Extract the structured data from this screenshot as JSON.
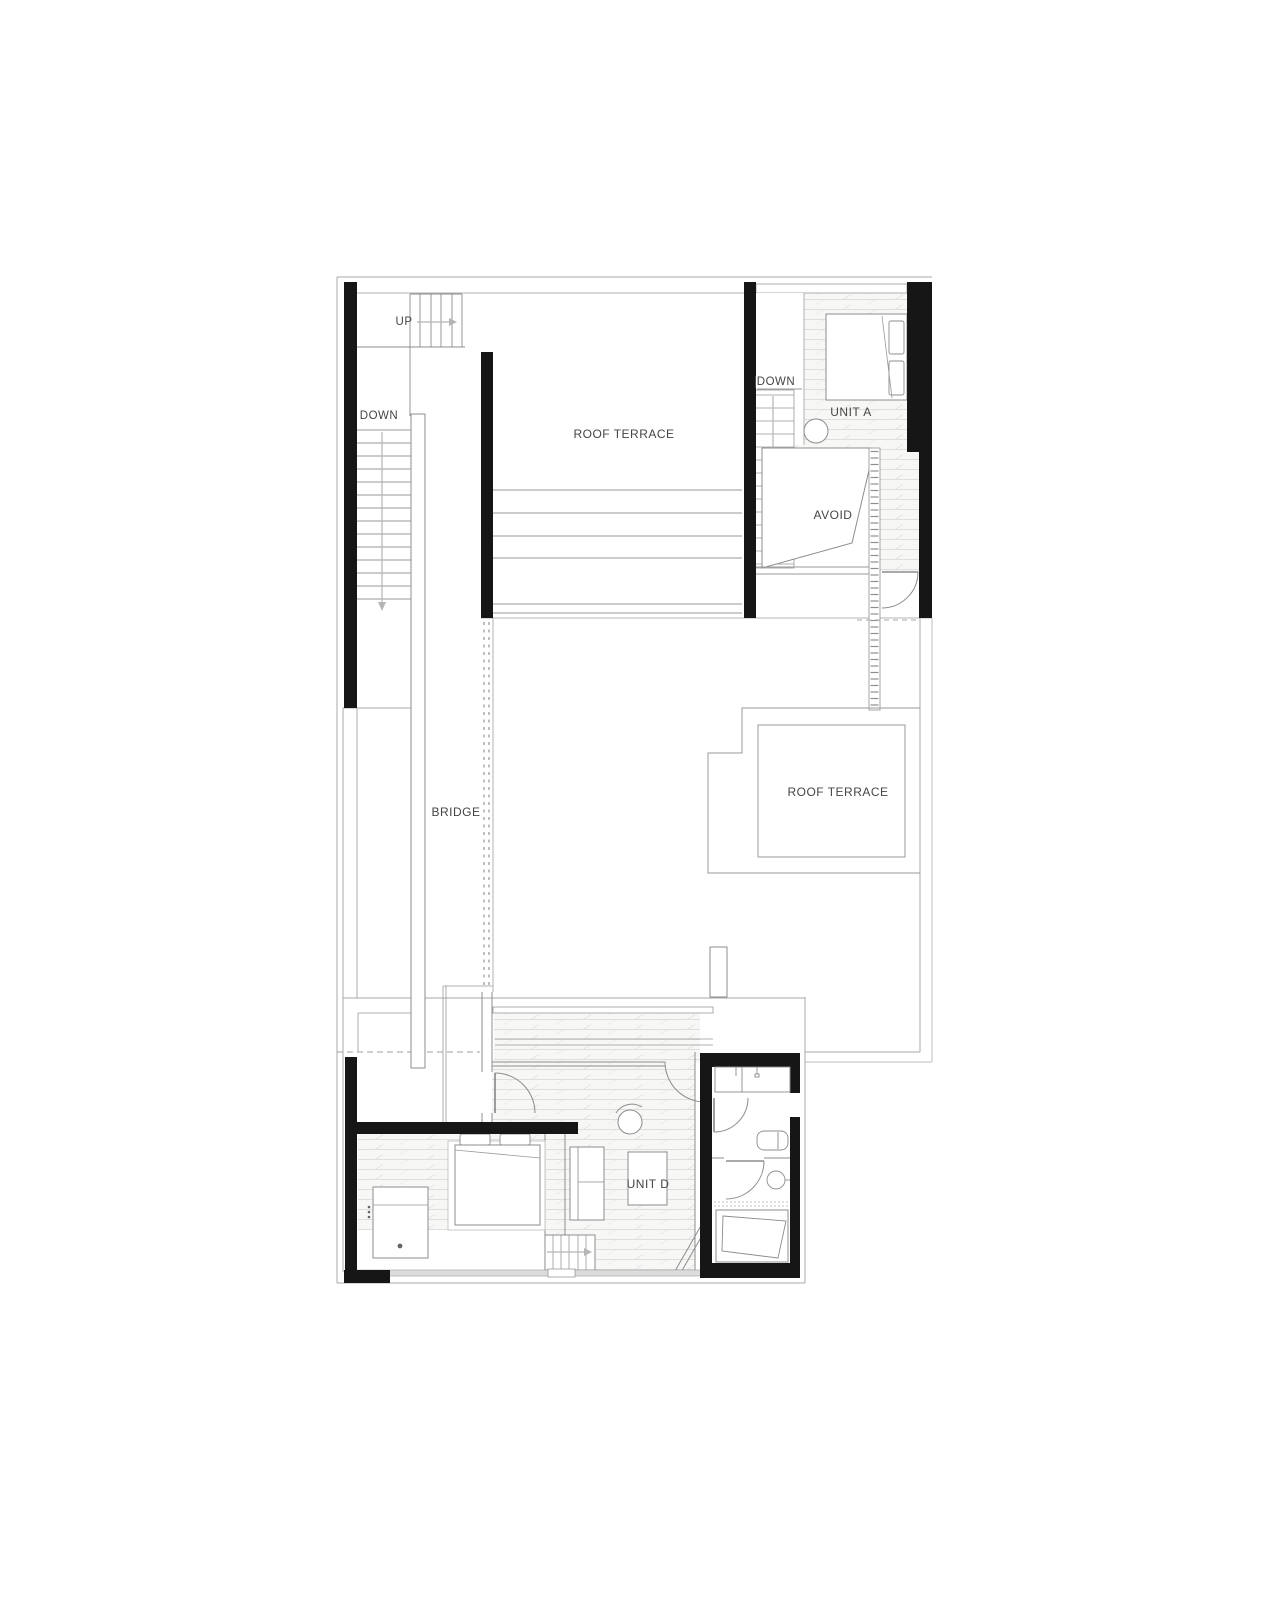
{
  "document": {
    "kind": "architectural floor plan, upper level",
    "background": "#ffffff"
  },
  "palette": {
    "wall_fill": "#161616",
    "line_dark": "#777777",
    "line_mid": "#8c8c8c",
    "line_light": "#b5b5b5",
    "hatch_line": "#dedede",
    "label_text": "#454545",
    "sill_fill": "#dcdcdc"
  },
  "labels": {
    "up": "UP",
    "down_west": "DOWN",
    "roof_terrace_upper": "ROOF TERRACE",
    "down_unit_a": "DOWN",
    "unit_a": "UNIT A",
    "avoid": "AVOID",
    "bridge": "BRIDGE",
    "roof_terrace_right": "ROOF TERRACE",
    "unit_d": "UNIT D"
  }
}
